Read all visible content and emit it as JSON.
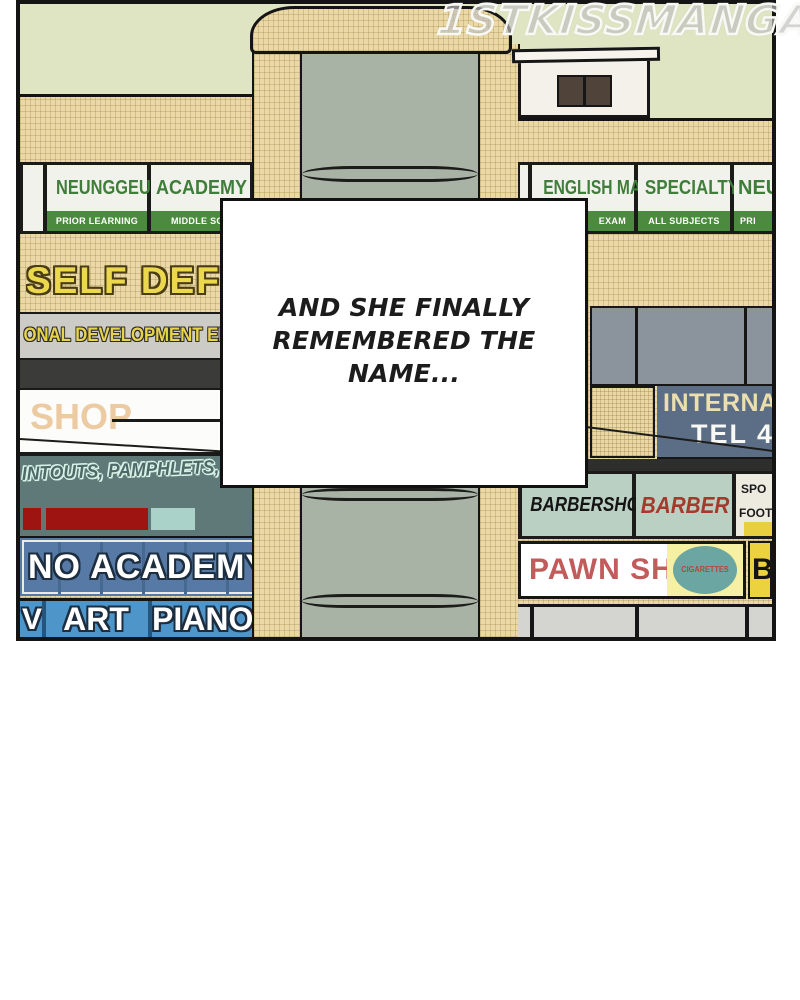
{
  "watermark": "1STKISSMANGA.IO",
  "caption": {
    "text": "AND SHE FINALLY\nREMEMBERED THE\nNAME..."
  },
  "building": {
    "left": {
      "academy_row": [
        {
          "title": "NEUNGGEUM",
          "subtitle": "PRIOR LEARNING"
        },
        {
          "title": "ACADEMY",
          "subtitle": "MIDDLE SCH"
        }
      ],
      "wall_text": "SELF DEFEN",
      "development_sign": "ONAL DEVELOPMENT EDUCA",
      "shop_sign": "SHOP",
      "print_sign": "INTOUTS, PAMPHLETS, BANNERS",
      "academy_sign": "NO ACADEMY",
      "art_sign": "ART",
      "piano_sign": "PIANO",
      "partial_letter": "V"
    },
    "right": {
      "academy_row": [
        {
          "title": "ENGLISH MATH",
          "subtitle": "EXAM"
        },
        {
          "title": "SPECIALTY",
          "subtitle": "ALL SUBJECTS"
        },
        {
          "title": "NEU",
          "subtitle": "PRI"
        }
      ],
      "telecom_sign": {
        "line1": "INTERNA",
        "line2": "TEL 4"
      },
      "barbershop_sign": "BARBERSHOP",
      "barber_sign": "BARBER",
      "sports_sign": {
        "line1": "SPO",
        "line2": "FOOT"
      },
      "pawn_sign": "PAWN SHOP",
      "cigarettes_sign": "CIGARETTES",
      "partial_sign": "BA"
    }
  },
  "colors": {
    "sky": "#dfe4c3",
    "brick": "#ead9a6",
    "glass": "#a8b2a5",
    "sign_green": "#3f7d3b",
    "band_green": "#4c8b3f",
    "yellow_text": "#ecd84f",
    "teal_sign": "#5e7977",
    "red_bar": "#9e1411",
    "academy_blue": "#567aa5",
    "row_blue": "#4e96ca",
    "telecom_blue": "#5c6e86",
    "barber_green": "#bad0c3",
    "pawn_red": "#c25b5b",
    "cigarette_teal": "#6ba6a2",
    "yellow_sign": "#ecd23e"
  }
}
